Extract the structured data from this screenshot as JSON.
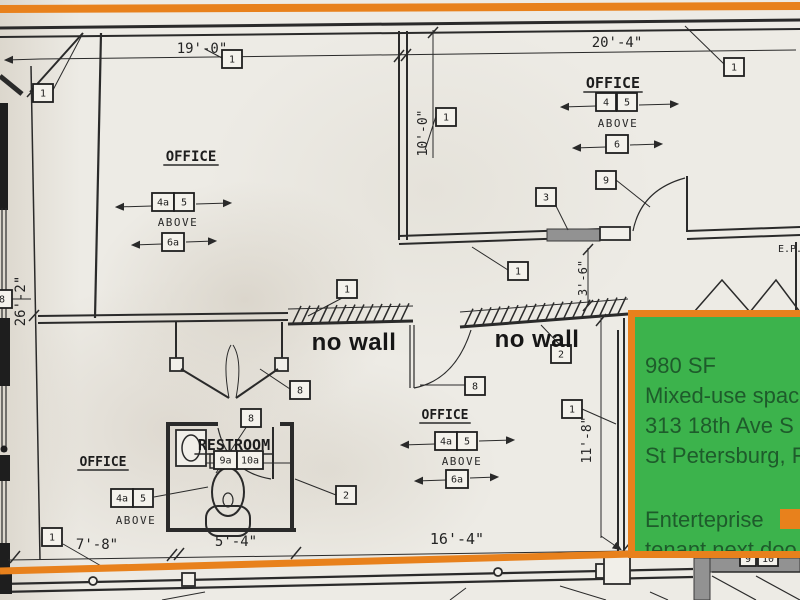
{
  "colors": {
    "paper": "#edebe5",
    "ink": "#2a2a2a",
    "orange_accent": "#e8811c",
    "listing_green": "#3cb34c",
    "listing_text_green": "#1e5b2b",
    "shaded_wall_gray": "#929292"
  },
  "plan": {
    "room_labels": [
      {
        "text": "OFFICE",
        "x": 613,
        "y": 88,
        "size": 15
      },
      {
        "text": "OFFICE",
        "x": 191,
        "y": 161,
        "size": 14
      },
      {
        "text": "OFFICE",
        "x": 103,
        "y": 466,
        "size": 13
      },
      {
        "text": "OFFICE",
        "x": 445,
        "y": 419,
        "size": 13
      },
      {
        "text": "RESTROOM",
        "x": 234,
        "y": 450,
        "size": 15
      }
    ],
    "above_labels": [
      {
        "text": "ABOVE",
        "x": 618,
        "y": 127
      },
      {
        "text": "ABOVE",
        "x": 178,
        "y": 226
      },
      {
        "text": "ABOVE",
        "x": 136,
        "y": 524
      },
      {
        "text": "ABOVE",
        "x": 462,
        "y": 465
      }
    ],
    "no_wall_annotations": [
      {
        "text": "no wall",
        "x": 354,
        "y": 350
      },
      {
        "text": "no wall",
        "x": 537,
        "y": 347
      }
    ],
    "dimensions": [
      {
        "text": "19'-0\"",
        "x": 202,
        "y": 53,
        "size": 14,
        "rotate": 0
      },
      {
        "text": "20'-4\"",
        "x": 617,
        "y": 47,
        "size": 14,
        "rotate": 0
      },
      {
        "text": "10'-0\"",
        "x": 427,
        "y": 133,
        "size": 13,
        "rotate": -90
      },
      {
        "text": "26'-2\"",
        "x": 25,
        "y": 301,
        "size": 14,
        "rotate": -90
      },
      {
        "text": "3'-6\"",
        "x": 587,
        "y": 278,
        "size": 12,
        "rotate": -90
      },
      {
        "text": "11'-8\"",
        "x": 591,
        "y": 440,
        "size": 13,
        "rotate": -90
      },
      {
        "text": "7'-8\"",
        "x": 97,
        "y": 549,
        "size": 14,
        "rotate": 0
      },
      {
        "text": "5'-4\"",
        "x": 236,
        "y": 546,
        "size": 14,
        "rotate": 0
      },
      {
        "text": "16'-4\"",
        "x": 457,
        "y": 544,
        "size": 15,
        "rotate": 0
      },
      {
        "text": "E.P.",
        "x": 790,
        "y": 252,
        "size": 10,
        "rotate": 0
      }
    ],
    "keynote_tags": [
      {
        "label": "1",
        "x": 222,
        "y": 50
      },
      {
        "label": "1",
        "x": 33,
        "y": 84
      },
      {
        "label": "1",
        "x": 724,
        "y": 58
      },
      {
        "label": "1",
        "x": 436,
        "y": 108
      },
      {
        "label": "1",
        "x": 337,
        "y": 280
      },
      {
        "label": "2",
        "x": 551,
        "y": 345
      },
      {
        "label": "1",
        "x": 508,
        "y": 262
      },
      {
        "label": "3",
        "x": 536,
        "y": 188
      },
      {
        "label": "9",
        "x": 596,
        "y": 171
      },
      {
        "label": "1",
        "x": 562,
        "y": 400
      },
      {
        "label": "8",
        "x": 465,
        "y": 377
      },
      {
        "label": "8",
        "x": 290,
        "y": 381
      },
      {
        "label": "8",
        "x": 241,
        "y": 409
      },
      {
        "label": "8",
        "x": -8,
        "y": 290
      },
      {
        "label": "9a",
        "x": 214,
        "y": 451,
        "w": 23
      },
      {
        "label": "10a",
        "x": 237,
        "y": 451,
        "w": 26
      },
      {
        "label": "4",
        "x": 596,
        "y": 93
      },
      {
        "label": "5",
        "x": 617,
        "y": 93
      },
      {
        "label": "6",
        "x": 606,
        "y": 135,
        "w": 22
      },
      {
        "label": "4a",
        "x": 152,
        "y": 193,
        "w": 22
      },
      {
        "label": "5",
        "x": 174,
        "y": 193
      },
      {
        "label": "6a",
        "x": 162,
        "y": 233,
        "w": 22
      },
      {
        "label": "4a",
        "x": 111,
        "y": 489,
        "w": 22
      },
      {
        "label": "5",
        "x": 133,
        "y": 489
      },
      {
        "label": "4a",
        "x": 435,
        "y": 432,
        "w": 22
      },
      {
        "label": "5",
        "x": 457,
        "y": 432
      },
      {
        "label": "6a",
        "x": 446,
        "y": 470,
        "w": 22
      },
      {
        "label": "2",
        "x": 336,
        "y": 486
      },
      {
        "label": "1",
        "x": 42,
        "y": 528
      },
      {
        "label": "9",
        "x": 740,
        "y": 551,
        "w": 16,
        "h": 15
      },
      {
        "label": "10",
        "x": 758,
        "y": 551,
        "w": 20,
        "h": 15
      }
    ]
  },
  "listing_overlay": {
    "lines": [
      "980 SF",
      "Mixed-use spac",
      "313 18th Ave S",
      "St Petersburg, F"
    ],
    "tenant_word": "Enterteprise",
    "tenant_line2": "tenant next doo"
  }
}
